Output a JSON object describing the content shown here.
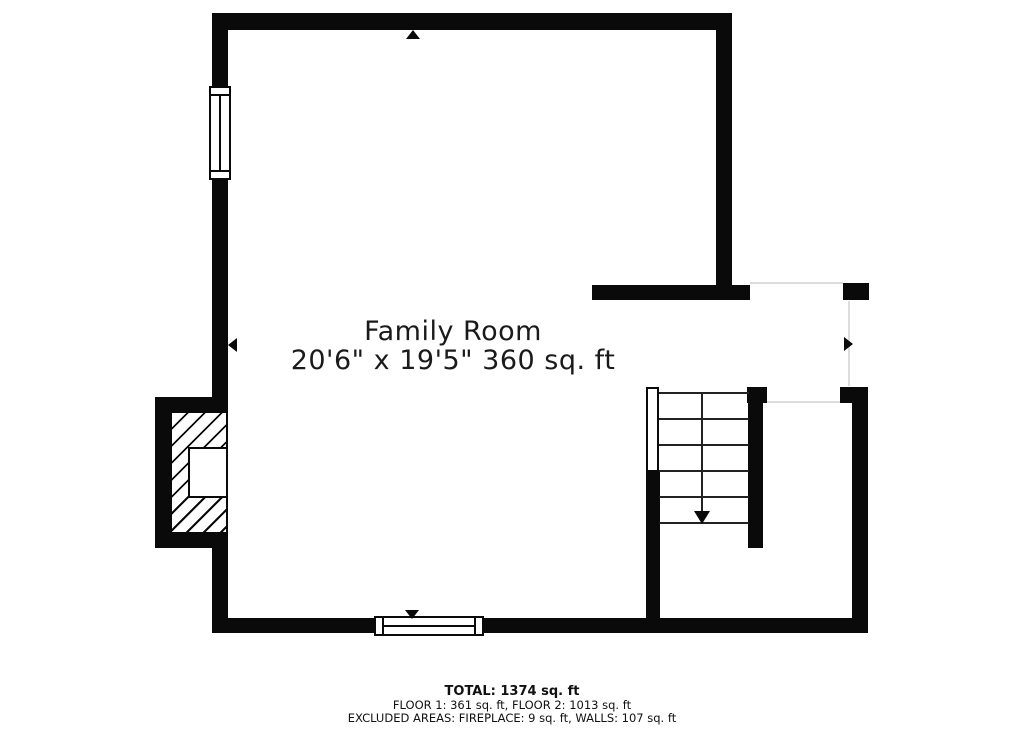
{
  "room": {
    "name": "Family Room",
    "dimensions": "20'6\" x 19'5\" 360 sq. ft"
  },
  "summary": {
    "total": "TOTAL: 1374 sq. ft",
    "floors": "FLOOR 1: 361 sq. ft, FLOOR 2: 1013 sq. ft",
    "excluded": "EXCLUDED AREAS: FIREPLACE: 9 sq. ft, WALLS: 107 sq. ft"
  },
  "colors": {
    "wall": "#0a0a0a",
    "background": "#ffffff",
    "opening": "#dcdcdc"
  },
  "symbols": {
    "stairs": {
      "direction": "down",
      "treads": 5
    },
    "windows": [
      "left-wall-window",
      "bottom-wall-window"
    ],
    "fireplace": "hatched-fireplace-with-firebox",
    "markers": [
      "up-arrow",
      "left-arrow",
      "down-arrow",
      "right-arrow"
    ]
  }
}
